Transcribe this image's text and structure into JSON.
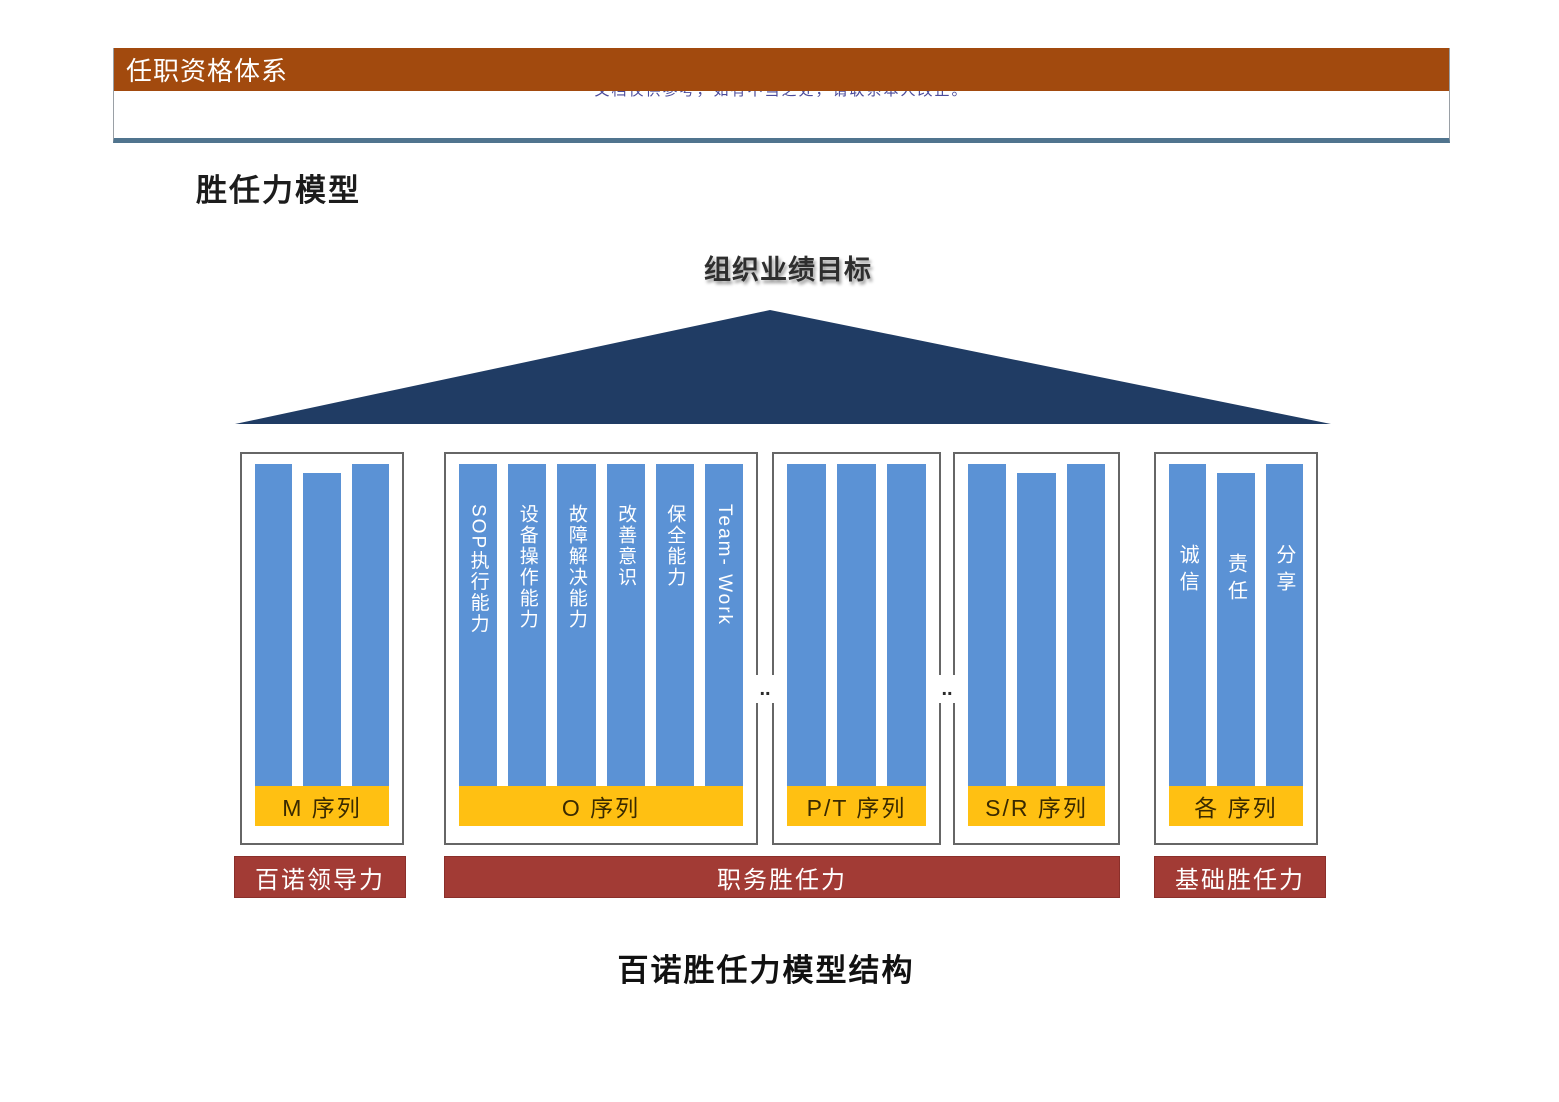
{
  "header": {
    "title": "任职资格体系",
    "notice": "文档仅供参考，如有不当之处，请联系本人改正。",
    "bar_color": "#A24A0E",
    "divider_color": "#50748E"
  },
  "page": {
    "section_title": "胜任力模型",
    "caption": "百诺胜任力模型结构"
  },
  "diagram": {
    "goal_label": "组织业绩目标",
    "ellipsis": "..",
    "colors": {
      "triangle": "#203C64",
      "pillar": "#5B92D5",
      "series_banner": "#FFC012",
      "competency_banner": "#A23B35",
      "box_border": "#666666"
    },
    "groups": [
      {
        "id": "m",
        "label": "M  序列",
        "columns": [
          "",
          "",
          ""
        ]
      },
      {
        "id": "o",
        "label": "O 序列",
        "columns": [
          "SOP执行能力",
          "设备操作能力",
          "故障解决能力",
          "改善意识",
          "保全能力",
          "Team- Work"
        ]
      },
      {
        "id": "p-t",
        "label": "P/T  序列",
        "columns": [
          "",
          "",
          ""
        ]
      },
      {
        "id": "s-r",
        "label": "S/R  序列",
        "columns": [
          "",
          "",
          ""
        ]
      },
      {
        "id": "all",
        "label": "各 序列",
        "columns": [
          "诚信",
          "责任",
          "分享"
        ]
      }
    ],
    "footers": [
      {
        "label": "百诺领导力"
      },
      {
        "label": "职务胜任力"
      },
      {
        "label": "基础胜任力"
      }
    ]
  }
}
